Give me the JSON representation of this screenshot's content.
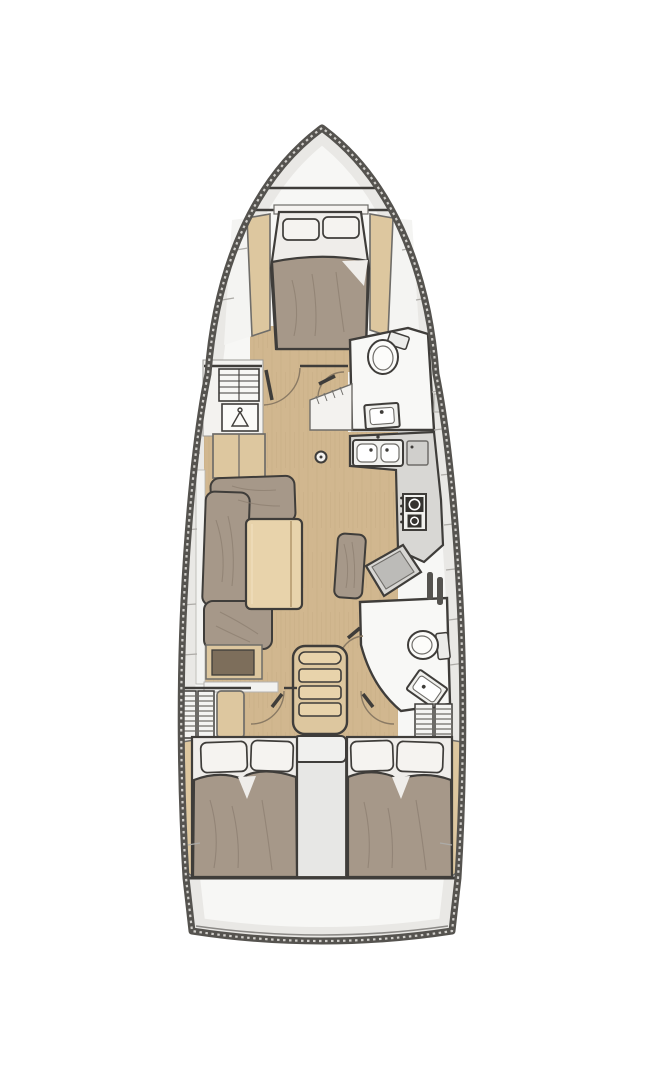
{
  "diagram": {
    "title": "Sailing yacht interior layout floor plan, bow up, three cabins and two heads",
    "type": "boat-floor-plan",
    "rooms": [
      "anchor-locker",
      "forward-owner-cabin-v-berth",
      "forward-head",
      "salon",
      "galley",
      "nav-station",
      "aft-head",
      "port-aft-cabin",
      "starboard-aft-cabin",
      "companionway",
      "engine-compartment",
      "transom"
    ],
    "furniture": [
      "island-double-berth",
      "pillows",
      "hull-shelves",
      "slatted-locker",
      "hanging-locker",
      "l-shaped-sofa",
      "folding-salon-table",
      "sideboard",
      "mast-post",
      "double-galley-sink",
      "refrigerator",
      "two-burner-stove",
      "nav-seat",
      "chart-table",
      "toilet",
      "washbasin",
      "companionway-steps",
      "wardrobe",
      "aft-double-berths"
    ],
    "colors": {
      "outline": "#3f3d3a",
      "line": "#6f6d69",
      "hull": "#55534f",
      "stipple": "#d8d6d2",
      "band": "#e9e8e5",
      "bandTick": "#adaba7",
      "white": "#f7f7f5",
      "room": "#f8f8f6",
      "floor": "#d1b78f",
      "floorGrain": "#c6ac84",
      "wood": "#ddc79f",
      "woodLight": "#e8d3ab",
      "woodEdge": "#b59a6f",
      "cushion": "#a69889",
      "cushionShadow": "#8b7d6f",
      "bedding": "#efedea",
      "pillow": "#f5f3f0",
      "counter": "#d8d7d4",
      "counterDark": "#bcbbb8",
      "appliance": "#34322f",
      "fixture": "#f1f1ee",
      "insetBrown": "#7d6e5b",
      "engine": "#e7e7e5",
      "arc": "#8a7a64"
    }
  }
}
